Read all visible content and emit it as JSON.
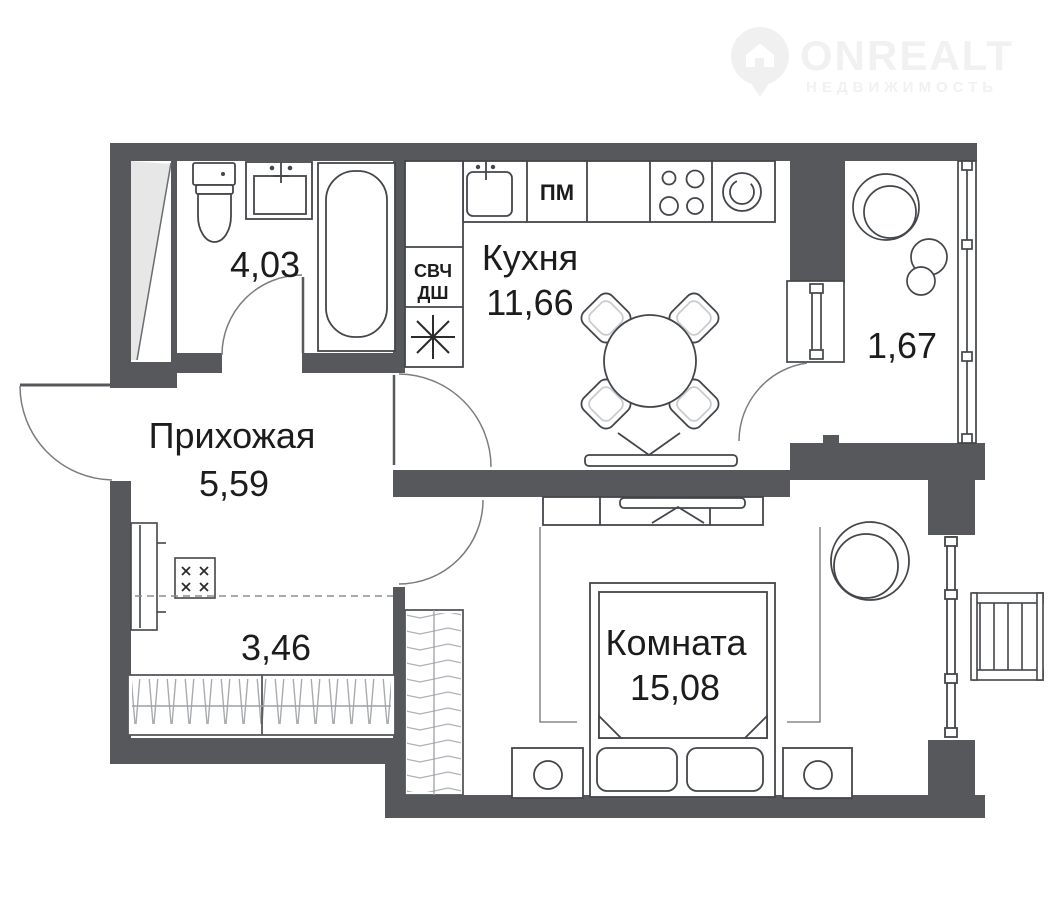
{
  "watermark": {
    "brand": "ONREALT",
    "tagline": "НЕДВИЖИМОСТЬ"
  },
  "rooms": {
    "bathroom": {
      "area": "4,03"
    },
    "kitchen": {
      "name": "Кухня",
      "area": "11,66"
    },
    "balcony": {
      "area": "1,67"
    },
    "hallway": {
      "name": "Прихожая",
      "area": "5,59"
    },
    "storage": {
      "area": "3,46"
    },
    "living_room": {
      "name": "Комната",
      "area": "15,08"
    }
  },
  "appliances": {
    "dishwasher_label": "ПМ",
    "microwave_label": "СВЧ",
    "oven_label": "ДШ"
  },
  "colors": {
    "wall": "#56585c",
    "fixture_line": "#43464a",
    "light_line": "#9aa0a4",
    "shaft_fill": "#e7e7e7",
    "watermark": "#f1f1f1",
    "text": "#1c1c1c",
    "background": "#ffffff"
  }
}
